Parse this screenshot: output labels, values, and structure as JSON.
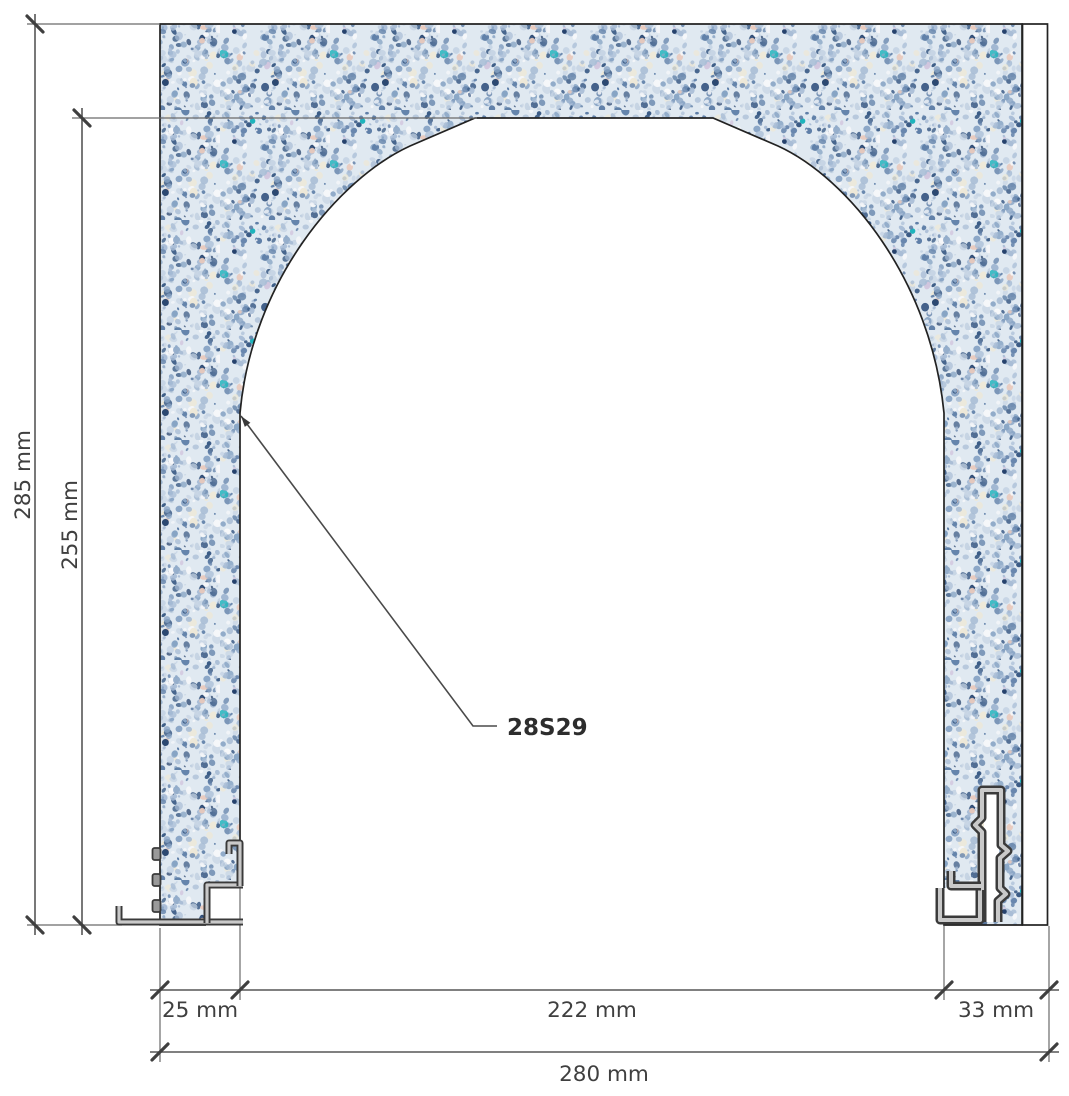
{
  "drawing": {
    "part_label": "28S29",
    "dims": {
      "overall_height": "285 mm",
      "opening_height": "255 mm",
      "left_jamb_width": "25 mm",
      "opening_width": "222 mm",
      "right_jamb_width": "33 mm",
      "overall_width": "280 mm"
    },
    "colors": {
      "masonry_base": "#e0e9f1",
      "speckle_dark_blue": "#3c5c86",
      "speckle_mid_blue": "#8aa6c6",
      "speckle_teal": "#19b2ba",
      "speckle_cream": "#ede8d8",
      "wood": "#a37a52",
      "wood_line": "#5c452f",
      "profile_metal": "#3a3a3a",
      "profile_core": "#c9c9c9",
      "dimension_line": "#565656",
      "text": "#3f3f3f"
    }
  }
}
